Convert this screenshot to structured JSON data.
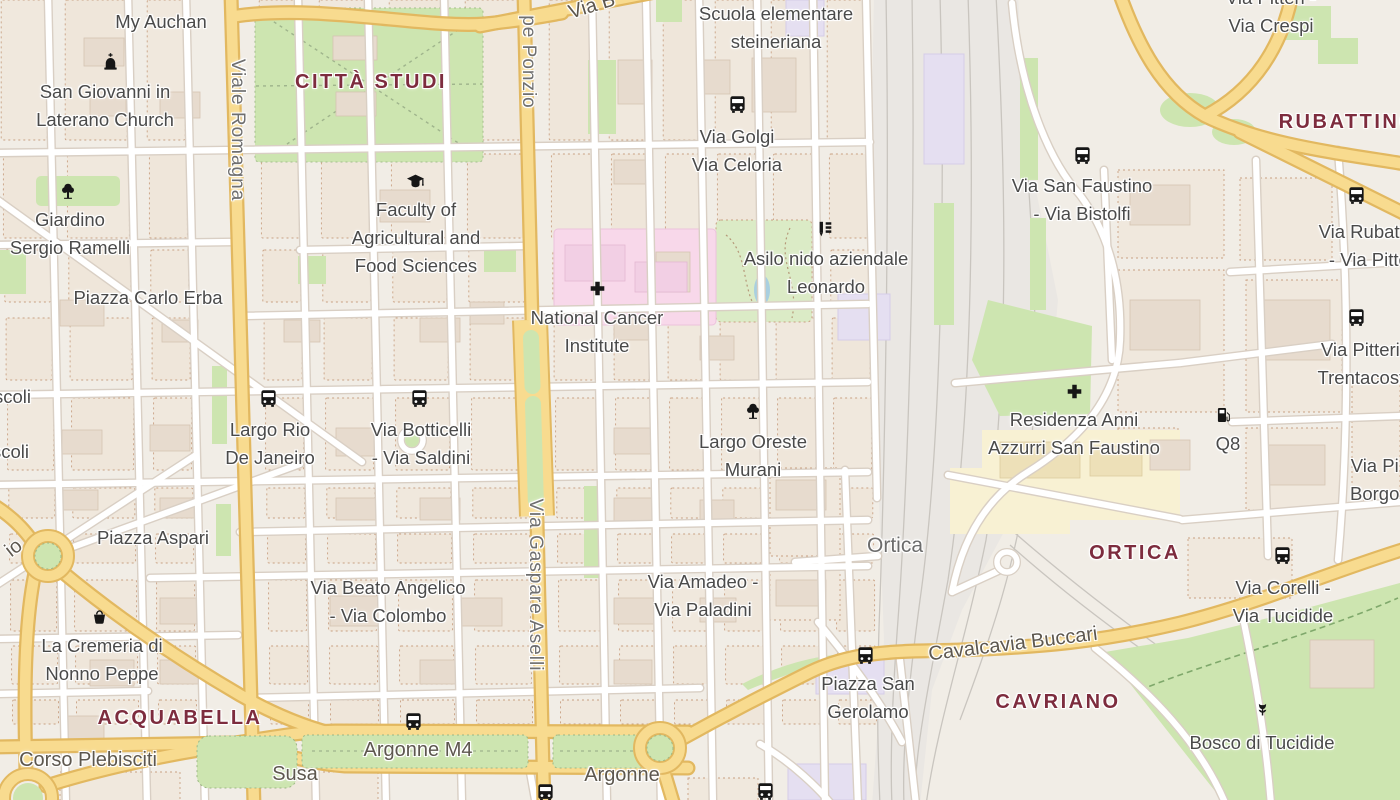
{
  "map": {
    "title": "Milan - Città Studi / Ortica map view",
    "districts": [
      "CITTÀ STUDI",
      "RUBATTINO",
      "ACQUABELLA",
      "ORTICA",
      "CAVRIANO"
    ],
    "labels": [
      {
        "id": "my-auchan",
        "type": "poi",
        "x": 161,
        "y": 8,
        "lines": [
          "My Auchan"
        ]
      },
      {
        "id": "san-giovanni-church",
        "type": "poi",
        "x": 105,
        "y": 78,
        "lines": [
          "San Giovanni in",
          "Laterano Church"
        ]
      },
      {
        "id": "citta-studi",
        "type": "district",
        "x": 371,
        "y": 70,
        "lines": [
          "CITTÀ STUDI"
        ]
      },
      {
        "id": "scuola-steineriana",
        "type": "poi",
        "x": 776,
        "y": 0,
        "lines": [
          "Scuola elementare",
          "steineriana"
        ]
      },
      {
        "id": "via-golgi-celoria",
        "type": "poi",
        "x": 737,
        "y": 123,
        "lines": [
          "Via Golgi",
          "Via Celoria"
        ]
      },
      {
        "id": "pitteri-crespi",
        "type": "poi",
        "x": 1271,
        "y": -16,
        "lines": [
          "Via Pitteri -",
          "Via Crespi"
        ]
      },
      {
        "id": "rubattino",
        "type": "district",
        "x": 1348,
        "y": 110,
        "lines": [
          "RUBATTINO"
        ]
      },
      {
        "id": "giardino-ramelli",
        "type": "poi",
        "x": 70,
        "y": 206,
        "lines": [
          "Giardino",
          "Sergio Ramelli"
        ]
      },
      {
        "id": "faculty-agriculture",
        "type": "poi",
        "x": 416,
        "y": 196,
        "lines": [
          "Faculty of",
          "Agricultural and",
          "Food Sciences"
        ]
      },
      {
        "id": "asilo-leonardo",
        "type": "poi",
        "x": 826,
        "y": 245,
        "lines": [
          "Asilo nido aziendale",
          "Leonardo"
        ]
      },
      {
        "id": "san-faustino-bistolfi",
        "type": "poi",
        "x": 1082,
        "y": 172,
        "lines": [
          "Via San Faustino",
          "- Via Bistolfi"
        ]
      },
      {
        "id": "rubattino-pitteri",
        "type": "poi",
        "x": 1374,
        "y": 218,
        "lines": [
          "Via Rubattino",
          "- Via Pitteri"
        ]
      },
      {
        "id": "national-cancer-institute",
        "type": "poi",
        "x": 597,
        "y": 304,
        "lines": [
          "National Cancer",
          "Institute"
        ]
      },
      {
        "id": "piazza-carlo-erba",
        "type": "poi",
        "x": 148,
        "y": 284,
        "lines": [
          "Piazza Carlo Erba"
        ]
      },
      {
        "id": "pitteri-trentacoste",
        "type": "poi",
        "x": 1366,
        "y": 336,
        "lines": [
          "Via Pitteri -",
          "Trentacoste"
        ]
      },
      {
        "id": "largo-rio-de-janeiro",
        "type": "poi",
        "x": 270,
        "y": 416,
        "lines": [
          "Largo Rio",
          "De Janeiro"
        ]
      },
      {
        "id": "botticelli-saldini",
        "type": "poi",
        "x": 421,
        "y": 416,
        "lines": [
          "Via Botticelli",
          "- Via Saldini"
        ]
      },
      {
        "id": "largo-oreste-murani",
        "type": "poi",
        "x": 753,
        "y": 428,
        "lines": [
          "Largo Oreste",
          "Murani"
        ]
      },
      {
        "id": "residenza-anni-azzurri",
        "type": "poi",
        "x": 1074,
        "y": 406,
        "lines": [
          "Residenza Anni",
          "Azzurri San Faustino"
        ]
      },
      {
        "id": "q8",
        "type": "poi",
        "x": 1228,
        "y": 430,
        "lines": [
          "Q8"
        ]
      },
      {
        "id": "via-pi-borgo",
        "type": "poi",
        "x": 1350,
        "y": 452,
        "align": "left",
        "lines": [
          "Via Pi",
          "Borgo"
        ]
      },
      {
        "id": "scoli-1",
        "type": "poi",
        "x": -6,
        "y": 383,
        "align": "left",
        "lines": [
          "scoli"
        ]
      },
      {
        "id": "scoli-2",
        "type": "poi",
        "x": -8,
        "y": 438,
        "align": "left",
        "lines": [
          "scoli"
        ]
      },
      {
        "id": "piazza-aspari",
        "type": "poi",
        "x": 153,
        "y": 524,
        "lines": [
          "Piazza Aspari"
        ]
      },
      {
        "id": "ortica-locality",
        "type": "locality",
        "x": 895,
        "y": 533,
        "lines": [
          "Ortica"
        ]
      },
      {
        "id": "ortica-district",
        "type": "district",
        "x": 1135,
        "y": 541,
        "lines": [
          "ORTICA"
        ]
      },
      {
        "id": "la-cremeria",
        "type": "poi",
        "x": 102,
        "y": 632,
        "lines": [
          "La Cremeria di",
          "Nonno Peppe"
        ]
      },
      {
        "id": "beato-angelico-colombo",
        "type": "poi",
        "x": 388,
        "y": 574,
        "lines": [
          "Via Beato Angelico",
          "- Via Colombo"
        ]
      },
      {
        "id": "amadeo-paladini",
        "type": "poi",
        "x": 703,
        "y": 568,
        "lines": [
          "Via Amadeo -",
          "Via Paladini"
        ]
      },
      {
        "id": "piazza-san-gerolamo",
        "type": "poi",
        "x": 868,
        "y": 670,
        "lines": [
          "Piazza San",
          "Gerolamo"
        ]
      },
      {
        "id": "corelli-tucidide",
        "type": "poi",
        "x": 1283,
        "y": 574,
        "lines": [
          "Via Corelli -",
          "Via Tucidide"
        ]
      },
      {
        "id": "bosco-di-tucidide",
        "type": "poi",
        "x": 1262,
        "y": 729,
        "lines": [
          "Bosco di Tucidide"
        ]
      },
      {
        "id": "cavriano",
        "type": "district",
        "x": 1058,
        "y": 690,
        "lines": [
          "CAVRIANO"
        ]
      },
      {
        "id": "acquabella",
        "type": "district",
        "x": 180,
        "y": 706,
        "lines": [
          "ACQUABELLA"
        ]
      },
      {
        "id": "corso-plebisciti",
        "type": "road",
        "x": 88,
        "y": 748,
        "lines": [
          "Corso Plebisciti"
        ]
      },
      {
        "id": "susa",
        "type": "road",
        "x": 295,
        "y": 762,
        "lines": [
          "Susa"
        ]
      },
      {
        "id": "argonne-m4",
        "type": "road",
        "x": 418,
        "y": 738,
        "lines": [
          "Argonne M4"
        ]
      },
      {
        "id": "argonne",
        "type": "road",
        "x": 622,
        "y": 763,
        "lines": [
          "Argonne"
        ]
      },
      {
        "id": "cavalcavia-buccari",
        "type": "road",
        "x": 1013,
        "y": 632,
        "rot": -7,
        "lines": [
          "Cavalcavia Buccari"
        ]
      },
      {
        "id": "viale-romagna",
        "type": "vstreet",
        "x": 237,
        "y": 130,
        "lines": [
          "Viale Romagna"
        ]
      },
      {
        "id": "pe-ponzio",
        "type": "vstreet",
        "x": 528,
        "y": 62,
        "lines": [
          "pe Ponzio"
        ]
      },
      {
        "id": "via-gaspare-aselli",
        "type": "vstreet",
        "x": 535,
        "y": 585,
        "lines": [
          "Via Gaspare Aselli"
        ]
      },
      {
        "id": "via-b-fragment",
        "type": "road",
        "x": 592,
        "y": -6,
        "rot": -17,
        "lines": [
          "Via B"
        ]
      },
      {
        "id": "io-fragment",
        "type": "road",
        "x": 14,
        "y": 536,
        "rot": -38,
        "lines": [
          "io"
        ]
      }
    ],
    "icons": [
      {
        "type": "church",
        "x": 110,
        "y": 61
      },
      {
        "type": "tree",
        "x": 68,
        "y": 191
      },
      {
        "type": "grad-cap",
        "x": 415,
        "y": 181
      },
      {
        "type": "hospital-cross",
        "x": 597,
        "y": 288
      },
      {
        "type": "hospital-cross",
        "x": 1074,
        "y": 391
      },
      {
        "type": "bus",
        "x": 737,
        "y": 104
      },
      {
        "type": "bus",
        "x": 268,
        "y": 398
      },
      {
        "type": "bus",
        "x": 419,
        "y": 398
      },
      {
        "type": "bus",
        "x": 1082,
        "y": 155
      },
      {
        "type": "bus",
        "x": 1356,
        "y": 195
      },
      {
        "type": "bus",
        "x": 1356,
        "y": 317
      },
      {
        "type": "bus",
        "x": 865,
        "y": 655
      },
      {
        "type": "bus",
        "x": 413,
        "y": 721
      },
      {
        "type": "bus",
        "x": 545,
        "y": 792
      },
      {
        "type": "bus",
        "x": 765,
        "y": 791
      },
      {
        "type": "bus",
        "x": 1282,
        "y": 555
      },
      {
        "type": "fuel",
        "x": 1224,
        "y": 415
      },
      {
        "type": "basket",
        "x": 99,
        "y": 616
      },
      {
        "type": "flower",
        "x": 1262,
        "y": 709
      },
      {
        "type": "school-supplies",
        "x": 825,
        "y": 229
      },
      {
        "type": "tree",
        "x": 753,
        "y": 411
      }
    ],
    "colors": {
      "land": "#F1EDE6",
      "block": "#F0E8DD",
      "road_yellow": "#F8DB8F",
      "road_yellow_casing": "#E2B860",
      "street_fill": "#FFFFFF",
      "street_casing": "#D9CFC4",
      "park": "#CDE5B0",
      "hospital_pink": "#F8D8EA",
      "lavender": "#E5DFF1",
      "railway": "#EAE7E3",
      "water": "#A9CFE0",
      "district_label": "#7d2c3e",
      "poi_label": "#4a4a4a",
      "road_label": "#5d574e",
      "vstreet_label": "#6f6f6f"
    }
  }
}
